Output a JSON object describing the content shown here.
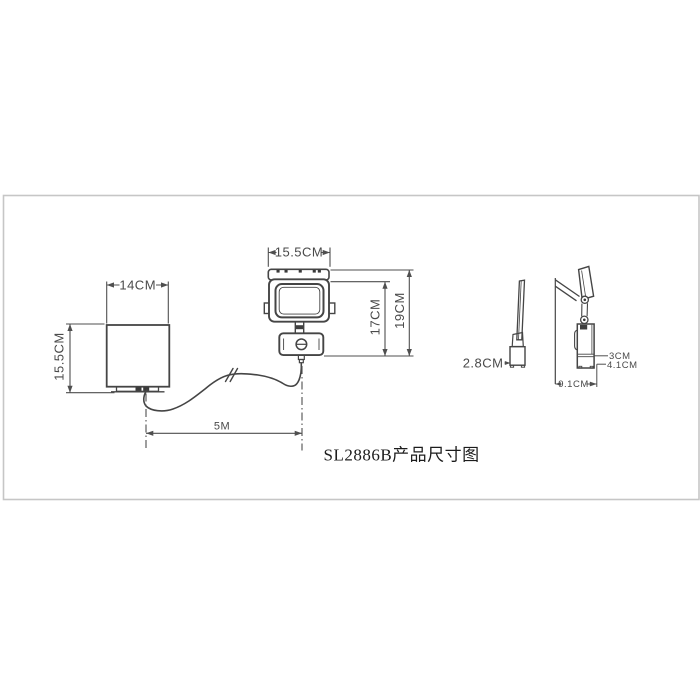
{
  "drawing": {
    "title": "SL2886B产品尺寸图",
    "dimensions": {
      "panel_front_width": "14CM",
      "panel_front_height": "15.5CM",
      "light_front_width": "15.5CM",
      "light_body_height": "17CM",
      "light_total_height": "19CM",
      "cable_length": "5M",
      "panel_side_depth": "2.8CM",
      "light_side_upper_depth": "3CM",
      "light_side_lower_depth": "4.1CM",
      "light_side_total_depth": "9.1CM"
    }
  },
  "colors": {
    "background": "#ffffff",
    "frame": "#c6c6c6",
    "object_line": "#454545",
    "dimension_line": "#4f4f4f",
    "title_text": "#1c1c1c"
  }
}
